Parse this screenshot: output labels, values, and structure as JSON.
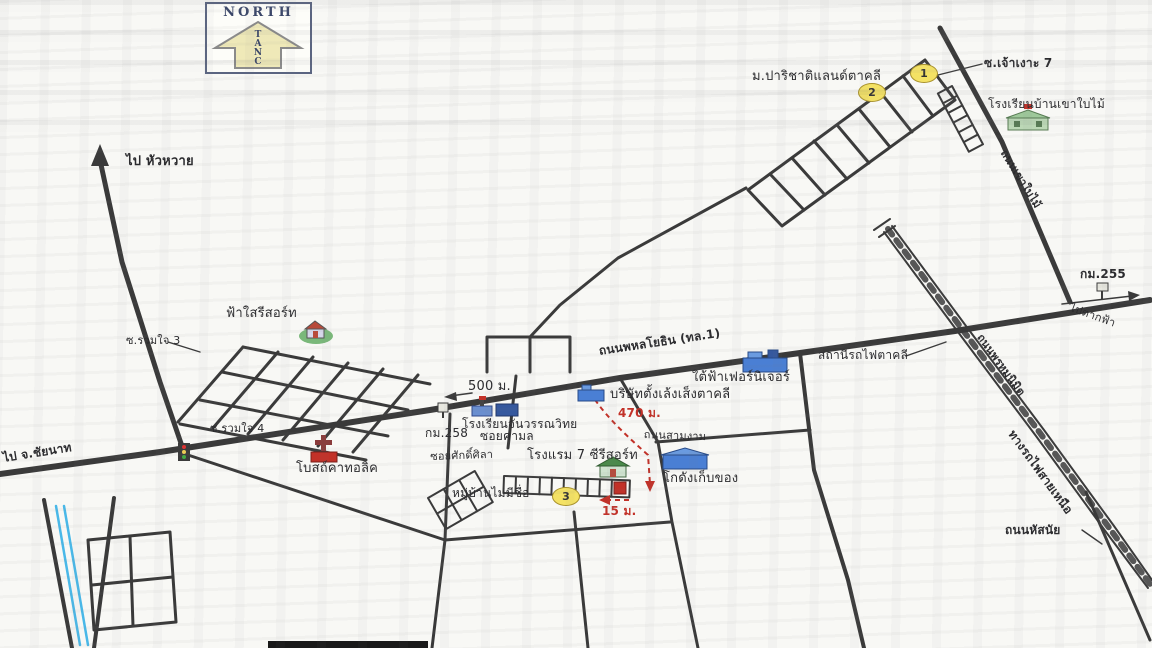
{
  "compass": {
    "title": "NORTH",
    "letters": [
      "T",
      "A",
      "N",
      "C"
    ]
  },
  "colors": {
    "road": "#3a3a3a",
    "accent_red": "#c23128",
    "badge_fill": "#f4e264",
    "canal_blue": "#49b8e8",
    "paper": "#f8f8f5",
    "school_green": "#9ec89a",
    "building_blue": "#4a7fd4"
  },
  "badges": [
    {
      "n": "1",
      "x": 923,
      "y": 73
    },
    {
      "n": "2",
      "x": 871,
      "y": 92
    },
    {
      "n": "3",
      "x": 565,
      "y": 496
    }
  ],
  "labels": [
    {
      "id": "to-huawai",
      "text": "ไป หัวหวาย",
      "x": 126,
      "y": 155,
      "fs": 13,
      "fw": 700,
      "rot": 0,
      "color": "#2b2b2e"
    },
    {
      "id": "parichat-land",
      "text": "ม.ปาริชาติแลนด์ตาคลี",
      "x": 752,
      "y": 70,
      "fs": 13,
      "fw": 400,
      "rot": 0,
      "color": "#2b2b2e"
    },
    {
      "id": "soi-chao-ngo-7",
      "text": "ซ.เจ้าเงาะ 7",
      "x": 984,
      "y": 57,
      "fs": 12,
      "fw": 700,
      "rot": 0,
      "color": "#2b2b2e"
    },
    {
      "id": "ban-khao-baimai-school",
      "text": "โรงเรียนบ้านเขาใบไม้",
      "x": 988,
      "y": 98,
      "fs": 12,
      "fw": 400,
      "rot": 0,
      "color": "#2b2b2e"
    },
    {
      "id": "khao-baimai-road",
      "text": "ถนนเขาใบไม้",
      "x": 1008,
      "y": 148,
      "fs": 11,
      "fw": 700,
      "rot": 58,
      "color": "#2b2b2e"
    },
    {
      "id": "km-255",
      "text": "กม.255",
      "x": 1080,
      "y": 268,
      "fs": 12,
      "fw": 700,
      "rot": 0,
      "color": "#2b2b2e"
    },
    {
      "id": "to-takfa",
      "text": "ไปตากฟ้า",
      "x": 1072,
      "y": 302,
      "fs": 11,
      "fw": 400,
      "rot": 20,
      "color": "#2b2b2e"
    },
    {
      "id": "phrom-nimit-road",
      "text": "ถนนพรหมนิมิต",
      "x": 984,
      "y": 332,
      "fs": 11,
      "fw": 700,
      "rot": 54,
      "color": "#2b2b2e"
    },
    {
      "id": "northern-railway",
      "text": "ทางรถไฟสายเหนือ",
      "x": 1016,
      "y": 428,
      "fs": 12,
      "fw": 700,
      "rot": 54,
      "color": "#2b2b2e"
    },
    {
      "id": "takhli-station",
      "text": "สถานีรถไฟตาคลี",
      "x": 818,
      "y": 349,
      "fs": 12,
      "fw": 400,
      "rot": 0,
      "color": "#2b2b2e"
    },
    {
      "id": "phahonyothin-road",
      "text": "ถนนพหลโยธิน (ทล.1)",
      "x": 598,
      "y": 345,
      "fs": 12,
      "fw": 700,
      "rot": -8.5,
      "color": "#2b2b2e"
    },
    {
      "id": "taifa-furniture",
      "text": "ใต้ฟ้าเฟอร์นิเจอร์",
      "x": 692,
      "y": 371,
      "fs": 13,
      "fw": 400,
      "rot": 0,
      "color": "#2b2b2e"
    },
    {
      "id": "tang-leng-seng-company",
      "text": "บริษัทตั้งเล้งเส็งตาคลี",
      "x": 610,
      "y": 388,
      "fs": 13,
      "fw": 400,
      "rot": 0,
      "color": "#2b2b2e"
    },
    {
      "id": "dist-470m",
      "text": "470 ม.",
      "x": 618,
      "y": 407,
      "fs": 12,
      "fw": 700,
      "rot": 0,
      "color": "#c23128"
    },
    {
      "id": "sam-ngam-road",
      "text": "ถนนสามงาม",
      "x": 644,
      "y": 429,
      "fs": 11,
      "fw": 400,
      "rot": 2,
      "color": "#2b2b2e"
    },
    {
      "id": "dist-500m",
      "text": "500 ม.",
      "x": 468,
      "y": 380,
      "fs": 13,
      "fw": 400,
      "rot": 0,
      "color": "#2b2b2e"
    },
    {
      "id": "chanwan-school",
      "text": "โรงเรียนจันวรรณวิทย",
      "x": 462,
      "y": 418,
      "fs": 12,
      "fw": 400,
      "rot": 0,
      "color": "#2b2b2e"
    },
    {
      "id": "km-258",
      "text": "กม.258",
      "x": 425,
      "y": 427,
      "fs": 12,
      "fw": 400,
      "rot": 0,
      "color": "#2b2b2e"
    },
    {
      "id": "soi-khamon",
      "text": "ซอยคามล",
      "x": 480,
      "y": 430,
      "fs": 12,
      "fw": 400,
      "rot": 0,
      "color": "#2b2b2e"
    },
    {
      "id": "soi-sak-sila",
      "text": "ซอยศักดิ์ศิลา",
      "x": 430,
      "y": 451,
      "fs": 11,
      "fw": 400,
      "rot": -2,
      "color": "#2b2b2e"
    },
    {
      "id": "hotel-7c-resort",
      "text": "โรงแรม 7 ซีรีสอร์ท",
      "x": 527,
      "y": 449,
      "fs": 13,
      "fw": 400,
      "rot": 0,
      "color": "#2b2b2e"
    },
    {
      "id": "unnamed-village",
      "text": "หมู่บ้านไม่มีชื่อ",
      "x": 452,
      "y": 487,
      "fs": 12,
      "fw": 400,
      "rot": 0,
      "color": "#2b2b2e"
    },
    {
      "id": "dist-15m",
      "text": "15 ม.",
      "x": 602,
      "y": 505,
      "fs": 12,
      "fw": 700,
      "rot": 0,
      "color": "#c23128"
    },
    {
      "id": "storage-warehouse",
      "text": "โกดังเก็บของ",
      "x": 663,
      "y": 472,
      "fs": 13,
      "fw": 400,
      "rot": 0,
      "color": "#2b2b2e"
    },
    {
      "id": "to-chainat",
      "text": "ไป จ.ชัยนาท",
      "x": 2,
      "y": 452,
      "fs": 12,
      "fw": 700,
      "rot": -9,
      "color": "#2b2b2e"
    },
    {
      "id": "fasai-resort",
      "text": "ฟ้าใสรีสอร์ท",
      "x": 226,
      "y": 307,
      "fs": 13,
      "fw": 400,
      "rot": 0,
      "color": "#2b2b2e"
    },
    {
      "id": "soi-ruamjai-3",
      "text": "ซ.รวมใจ 3",
      "x": 126,
      "y": 335,
      "fs": 11,
      "fw": 400,
      "rot": 0,
      "color": "#2b2b2e"
    },
    {
      "id": "soi-ruamjai-4",
      "text": "ซ.รวมใจ 4",
      "x": 210,
      "y": 423,
      "fs": 11,
      "fw": 400,
      "rot": 0,
      "color": "#2b2b2e"
    },
    {
      "id": "catholic-church",
      "text": "โบสถ์คาทอลิค",
      "x": 296,
      "y": 462,
      "fs": 13,
      "fw": 400,
      "rot": 0,
      "color": "#2b2b2e"
    },
    {
      "id": "hatsanai-road",
      "text": "ถนนหัสนัย",
      "x": 1005,
      "y": 524,
      "fs": 12,
      "fw": 700,
      "rot": 0,
      "color": "#2b2b2e"
    }
  ]
}
